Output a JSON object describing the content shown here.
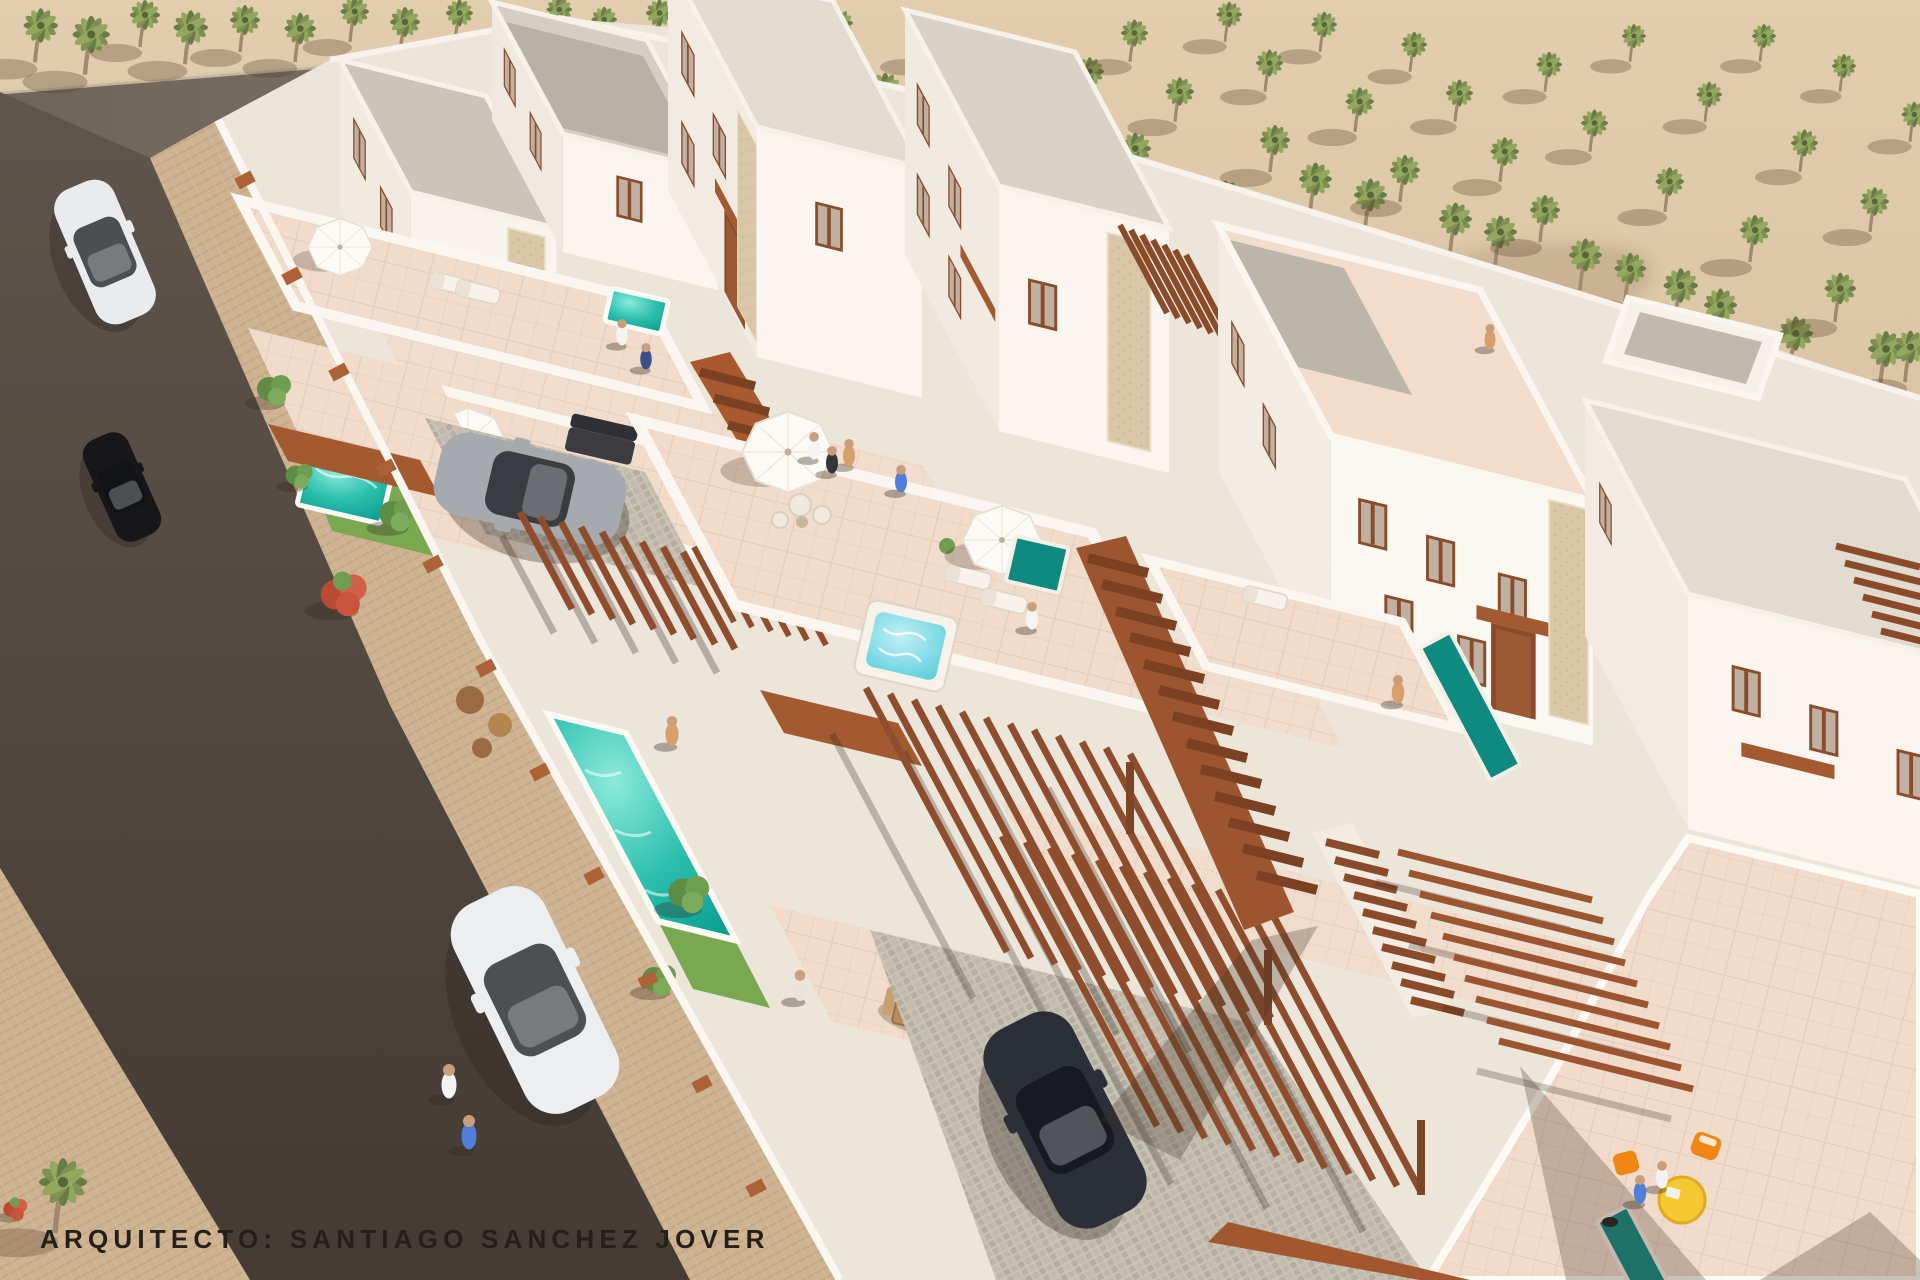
{
  "image_type": "3d-aerial-architectural-rendering",
  "caption": {
    "text": "ARQUITECTO: SANTIAGO SANCHEZ JOVER"
  },
  "palette": {
    "sand": "#dcc7a8",
    "rear_road": "#7d7267",
    "main_road": "#554a41",
    "sidewalk": "#cdb392",
    "villa_white": "#f3eee6",
    "wall_white": "#fbf7f0",
    "terrace_floor": "#f1dccb",
    "roof_gravel": "#c3bcb0",
    "stone_cladding": "#d9c7a8",
    "pergola_wood": "#8e4e2d",
    "awning": "#a35a31",
    "stair_wood": "#9d5530",
    "pool_water": "#2cbfae",
    "lap_pool_water": "#0e8a80",
    "jacuzzi_water": "#5fd0de",
    "grass": "#79a851",
    "palm_foliage": "#7e9152",
    "palm_trunk": "#a08a6f",
    "flowering_tree": "#c8543c",
    "car_white": "#e9ebed",
    "car_black": "#17171a",
    "car_silver": "#a6a9ad",
    "car_dark": "#2b2f38",
    "chair_orange": "#f08614",
    "table_yellow": "#f6c832",
    "caption_color": "#251f1a"
  },
  "scene": {
    "setting": "whitewashed villa development beside a desert palm grove",
    "landscape": {
      "palm_trees": 61,
      "green_trees": 5,
      "flowering_red_trees": 2,
      "sand_ground": true
    },
    "roads": {
      "asphalt_streets": 2,
      "paved_sidewalks": true
    },
    "buildings": {
      "front_row_villas": 6,
      "rear_two_storey_volumes": 7,
      "roof_terraces": 5
    },
    "amenities": {
      "garden_pools": 2,
      "plunge_pools": 2,
      "lap_pools": 3,
      "jacuzzis": 1,
      "white_parasols": 4,
      "pergolas": 5,
      "outdoor_staircases": 3,
      "dining_sets": 2,
      "sun_loungers": 5
    },
    "vehicles": [
      {
        "name": "white-hatchback-upper-road",
        "color": "#e9ebed"
      },
      {
        "name": "black-sedan-left-road",
        "color": "#17171a"
      },
      {
        "name": "white-sedan-lower-road",
        "color": "#eceef0"
      },
      {
        "name": "silver-sedan-driveway",
        "color": "#a6a9ad"
      },
      {
        "name": "dark-suv-carport",
        "color": "#2b2f38"
      }
    ],
    "people_count": 15,
    "furniture_accents": {
      "orange_chairs": 2,
      "yellow_bistro_table": 1
    }
  }
}
